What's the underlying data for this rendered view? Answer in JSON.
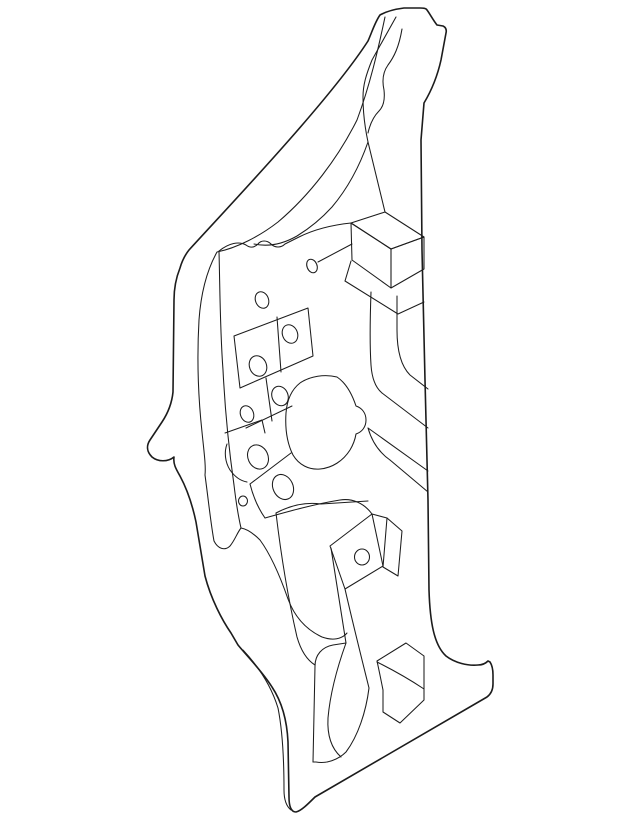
{
  "figure": {
    "description": "black and white technical line drawing of an automotive body side hinge pillar panel, isometric view, no text or labels",
    "canvas": {
      "width": 640,
      "height": 826
    },
    "background": "#ffffff",
    "stroke": {
      "color": "#1c1c1c",
      "width_main": 1.05,
      "width_outline": 1.6
    },
    "paths": [
      {
        "name": "outer-contour",
        "w": 1.6,
        "d": "M 380 15 C 387 11 396 9 404 8 L 420 8 C 423 8 426 8 427 10 C 430 14 433 20 437 25 L 443 26 C 445 27 447 29 446 33 L 441 60 C 437 78 430 93 424 103 L 421 140 L 422 250 L 425 380 L 428 500 L 429 590 C 430 622 434 645 446 656 C 455 663 468 666 478 665 C 482 665 485 664 488 661 L 490 662 C 492 665 493 669 493 675 L 493 684 C 493 690 491 694 487 697 L 315 797 C 308 804 301 811 296 812 C 291 812 289 806 289 797 L 288 742 C 287 720 282 702 272 687 C 262 671 247 656 238 645 L 231 633 C 222 620 211 599 205 576 L 196 522 C 192 503 187 489 180 476 C 176 469 173 464 174 457 C 168 462 158 462 152 457 C 147 452 146 446 150 440 L 162 422 C 168 413 172 402 173 392 L 174 300 C 174 288 176 278 180 268 C 182 261 185 255 189 250 C 230 205 330 100 368 41 C 372 32 375 22 380 15 Z"
      },
      {
        "name": "channel-inner-line",
        "d": "M 385 17 C 378 50 370 85 357 120 C 338 158 310 195 278 222 C 260 236 237 248 217 252 C 207 270 201 292 199 320 C 197 355 198 395 202 432 C 204 452 206 466 205 475 C 209 505 211 525 214 541 C 218 549 225 551 230 546 C 235 540 237 533 241 528"
      },
      {
        "name": "web-fold-line",
        "d": "M 219 251 C 220 290 220 330 223 370 C 225 410 229 450 234 485 C 236 502 238 515 241 528"
      },
      {
        "name": "saddle-curve",
        "d": "M 241 528 C 247 529 254 534 260 540 C 271 555 280 576 288 599 C 295 618 307 630 322 637 C 333 641 342 639 347 633"
      },
      {
        "name": "tip-ridge-line",
        "d": "M 396 17 L 372 60 C 366 75 363 85 363 97 C 363 113 365 128 368 142 C 360 165 348 188 332 207 C 322 218 310 228 297 236 C 283 244 268 247 254 244"
      },
      {
        "name": "tip-pocket-line",
        "d": "M 402 29 C 399 47 394 57 388 65 C 383 72 382 81 384 90 C 385 99 384 106 379 111 C 374 116 370 124 368 133"
      },
      {
        "name": "wavy-seam-line",
        "d": "M 219 251 C 229 243 239 241 246 245 C 250 248 254 248 258 244 C 261 240 267 240 271 244 C 275 248 281 248 285 244 L 299 237 C 315 229 332 225 351 223"
      },
      {
        "name": "wavy-parallel-line",
        "d": "M 318 262 L 352 244"
      },
      {
        "name": "bracket-box-top",
        "d": "M 351 223 L 385 212 L 424 237 L 391 249 Z"
      },
      {
        "name": "bracket-box-front",
        "d": "M 351 223 L 352 260 L 391 288 L 391 249 Z"
      },
      {
        "name": "bracket-box-side",
        "d": "M 391 249 L 391 288 L 424 269 L 424 237 Z"
      },
      {
        "name": "box-apex-line",
        "d": "M 385 212 C 379 188 374 166 368 142"
      },
      {
        "name": "under-box-band",
        "d": "M 345 281 L 398 314 L 424 302"
      },
      {
        "name": "under-box-cap",
        "d": "M 345 281 L 351 261"
      },
      {
        "name": "rib-vertical-1",
        "d": "M 371 292 C 370 320 370 350 371 365 C 372 380 376 388 382 393"
      },
      {
        "name": "rib-diagonal-1",
        "d": "M 382 393 L 428 428"
      },
      {
        "name": "rib-vertical-2",
        "d": "M 397 296 L 397 330 C 397 352 402 367 410 375 L 428 389"
      },
      {
        "name": "rib-diagonal-2",
        "d": "M 368 428 L 428 471"
      },
      {
        "name": "rib-connector",
        "d": "M 368 428 C 372 442 380 453 390 460"
      },
      {
        "name": "rib-diagonal-3",
        "d": "M 390 460 L 428 492"
      },
      {
        "name": "cell-strip-outline",
        "d": "M 234 336 L 308 308 L 313 356 L 240 388 Z"
      },
      {
        "name": "cell-strip-divider",
        "d": "M 277 317 L 281 372"
      },
      {
        "name": "lower-band-edge",
        "d": "M 246 428 L 292 406"
      },
      {
        "name": "lower-band-divider",
        "d": "M 266 378 L 272 421"
      },
      {
        "name": "plate-top-edge",
        "d": "M 225 433 L 262 420 L 265 433"
      },
      {
        "name": "plate-hook-curve",
        "d": "M 227 444 C 224 452 225 462 230 470 C 235 477 241 481 247 482"
      },
      {
        "name": "center-blob-outline",
        "d": "M 337 377 C 325 374 310 376 300 383 C 291 390 287 400 286 413 C 285 428 287 443 293 455 C 299 465 309 470 320 469 C 332 468 343 461 350 450 C 353 445 355 440 356 434 C 362 432 366 427 366 420 C 366 413 362 408 356 406 C 352 394 346 383 337 377 Z"
      },
      {
        "name": "oval-plate-top",
        "d": "M 250 484 L 291 453"
      },
      {
        "name": "oval-plate-left",
        "d": "M 250 484 C 253 496 258 508 265 518"
      },
      {
        "name": "oval-plate-bottom",
        "d": "M 265 518 C 290 511 315 504 340 500 C 352 498 364 503 372 514"
      },
      {
        "name": "hole-band-outline",
        "d": "M 330 546 L 372 514 L 383 566 L 345 589 Z"
      },
      {
        "name": "hole-band-extension",
        "d": "M 372 514 L 387 518"
      },
      {
        "name": "flag-bracket-outline",
        "d": "M 387 518 L 402 531 L 398 576 L 383 567 Z"
      },
      {
        "name": "band-top-edge",
        "d": "M 276 513 C 291 505 306 502 321 504 L 368 501"
      },
      {
        "name": "web-descender-line",
        "d": "M 276 513 C 281 555 288 598 297 637 C 301 651 307 660 315 665"
      },
      {
        "name": "strip-descender-1",
        "d": "M 345 589 C 353 624 361 656 369 688"
      },
      {
        "name": "strip-descender-2",
        "d": "M 331 548 C 336 580 341 612 346 643"
      },
      {
        "name": "sill-panel-left",
        "d": "M 313 762 L 315 666 C 315 655 322 647 333 645 L 346 643"
      },
      {
        "name": "sill-panel-inner",
        "d": "M 346 643 C 337 668 330 695 328 718 C 327 736 332 749 341 757"
      },
      {
        "name": "sill-panel-outer",
        "d": "M 369 688 C 366 712 358 736 346 752 C 338 760 326 764 316 762 L 313 762"
      },
      {
        "name": "corner-panel-outline",
        "d": "M 377 661 L 406 643 L 424 656 L 424 700 L 400 723 L 383 712 L 383 690 C 381 680 379 670 377 661 Z"
      },
      {
        "name": "corner-panel-crease",
        "d": "M 377 662 C 393 670 409 679 424 689"
      },
      {
        "name": "lower-flange-inner",
        "d": "M 243 650 C 258 666 271 685 278 708 C 282 728 284 758 284 790 C 284 799 286 806 291 810"
      }
    ],
    "holes": [
      {
        "name": "hole-1",
        "cx": 312,
        "cy": 266,
        "rx": 5,
        "ry": 7,
        "rot": -22
      },
      {
        "name": "hole-2",
        "cx": 262,
        "cy": 300,
        "rx": 6.5,
        "ry": 8.5,
        "rot": -22
      },
      {
        "name": "hole-3",
        "cx": 290,
        "cy": 334,
        "rx": 7.5,
        "ry": 9.5,
        "rot": -22
      },
      {
        "name": "hole-4",
        "cx": 258,
        "cy": 366,
        "rx": 8.5,
        "ry": 10.5,
        "rot": -22
      },
      {
        "name": "hole-5",
        "cx": 280,
        "cy": 396,
        "rx": 8,
        "ry": 10,
        "rot": -22
      },
      {
        "name": "hole-6",
        "cx": 247,
        "cy": 414,
        "rx": 6.5,
        "ry": 8.5,
        "rot": -22
      },
      {
        "name": "hole-7",
        "cx": 258,
        "cy": 457,
        "rx": 10,
        "ry": 12.5,
        "rot": -25
      },
      {
        "name": "hole-8",
        "cx": 283,
        "cy": 487,
        "rx": 10,
        "ry": 13,
        "rot": -25
      },
      {
        "name": "hole-9",
        "cx": 243,
        "cy": 501,
        "rx": 4.5,
        "ry": 5,
        "rot": 0
      },
      {
        "name": "hole-10",
        "cx": 362,
        "cy": 557,
        "rx": 7.5,
        "ry": 8,
        "rot": 0
      }
    ]
  }
}
